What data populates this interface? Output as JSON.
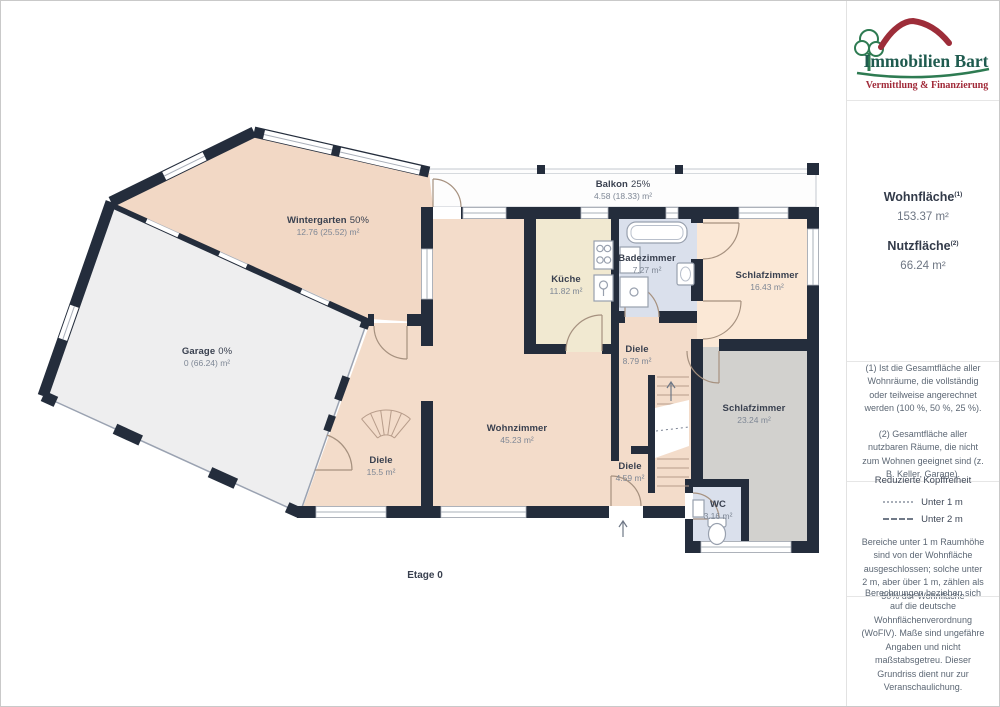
{
  "sidebar": {
    "logo": {
      "title": "Immobilien Bart",
      "subtitle": "Vermittlung & Finanzierung"
    },
    "summary": {
      "wohnflaeche_label": "Wohnfläche",
      "wohnflaeche_sup": "(1)",
      "wohnflaeche_value": "153.37 m²",
      "nutzflaeche_label": "Nutzfläche",
      "nutzflaeche_sup": "(2)",
      "nutzflaeche_value": "66.24 m²"
    },
    "notes": {
      "note1": "(1) Ist die Gesamtfläche aller Wohnräume, die vollständig oder teilweise angerechnet werden (100 %, 50 %, 25 %).",
      "note2": "(2) Gesamtfläche aller nutzbaren Räume, die nicht zum Wohnen geeignet sind (z. B. Keller, Garage)."
    },
    "headroom": {
      "title": "Reduzierte Kopffreiheit",
      "legend": [
        {
          "style": "dotted",
          "label": "Unter 1 m"
        },
        {
          "style": "dashed",
          "label": "Unter 2 m"
        }
      ],
      "note": "Bereiche unter 1 m Raumhöhe sind von der Wohnfläche ausgeschlossen; solche unter 2 m, aber über 1 m, zählen als 50% der Wohnfläche"
    },
    "disclaimer": "Berechnungen beziehen sich auf die deutsche Wohnflächenverordnung (WoFlV). Maße sind ungefähre Angaben und nicht maßstabsgetreu. Dieser Grundriss dient nur zur Veranschaulichung.",
    "brand": {
      "name": "GIRAFFE",
      "suffix": "360"
    }
  },
  "plan": {
    "floor_label": "Etage 0",
    "colors": {
      "wall": "#242d3c",
      "peach": "#f3dcca",
      "peach_deep": "#f2d8c5",
      "peach_light": "#fbe8d6",
      "cream": "#f1e9d1",
      "blue": "#dae0ec",
      "gray": "#d2d1ce",
      "garage": "#eeeeef",
      "balkon": "#fdfdfd"
    },
    "rooms": [
      {
        "id": "wintergarten",
        "name": "Wintergarten",
        "pct": "50%",
        "area": "12.76 (25.52) m²"
      },
      {
        "id": "balkon",
        "name": "Balkon",
        "pct": "25%",
        "area": "4.58 (18.33) m²"
      },
      {
        "id": "garage",
        "name": "Garage",
        "pct": "0%",
        "area": "0 (66.24) m²"
      },
      {
        "id": "kueche",
        "name": "Küche",
        "area": "11.82 m²"
      },
      {
        "id": "badezimmer",
        "name": "Badezimmer",
        "area": "7.27 m²"
      },
      {
        "id": "schlafzimmer1",
        "name": "Schlafzimmer",
        "area": "16.43 m²"
      },
      {
        "id": "diele1",
        "name": "Diele",
        "area": "8.79 m²"
      },
      {
        "id": "schlafzimmer2",
        "name": "Schlafzimmer",
        "area": "23.24 m²"
      },
      {
        "id": "wohnzimmer",
        "name": "Wohnzimmer",
        "area": "45.23 m²"
      },
      {
        "id": "diele2",
        "name": "Diele",
        "area": "15.5 m²"
      },
      {
        "id": "diele3",
        "name": "Diele",
        "area": "4.59 m²"
      },
      {
        "id": "wc",
        "name": "WC",
        "area": "3.16 m²"
      }
    ]
  }
}
